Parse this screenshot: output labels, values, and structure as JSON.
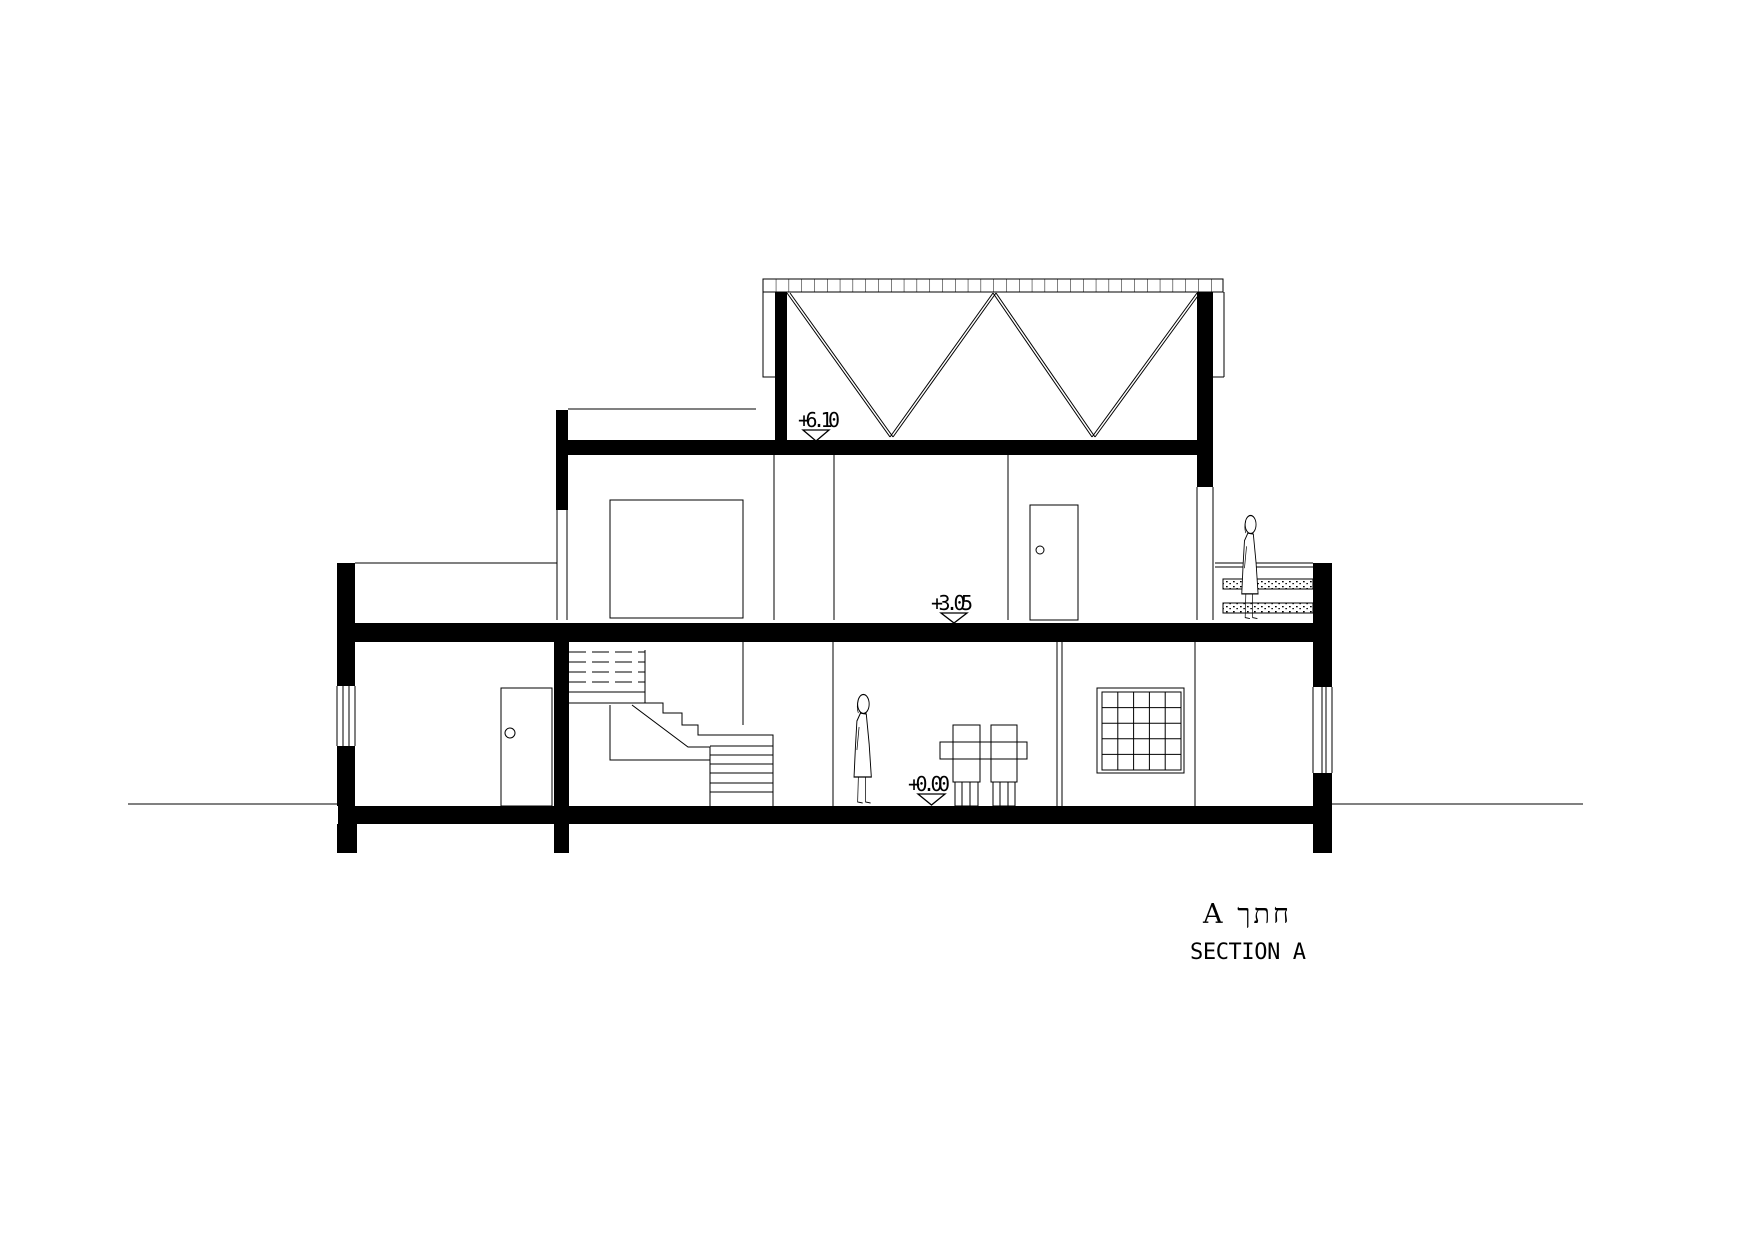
{
  "drawing": {
    "levels": {
      "roof": "+6.10",
      "upper": "+3.05",
      "ground": "+0.00"
    },
    "title_hebrew": "A חתך",
    "title_english": "SECTION A"
  }
}
